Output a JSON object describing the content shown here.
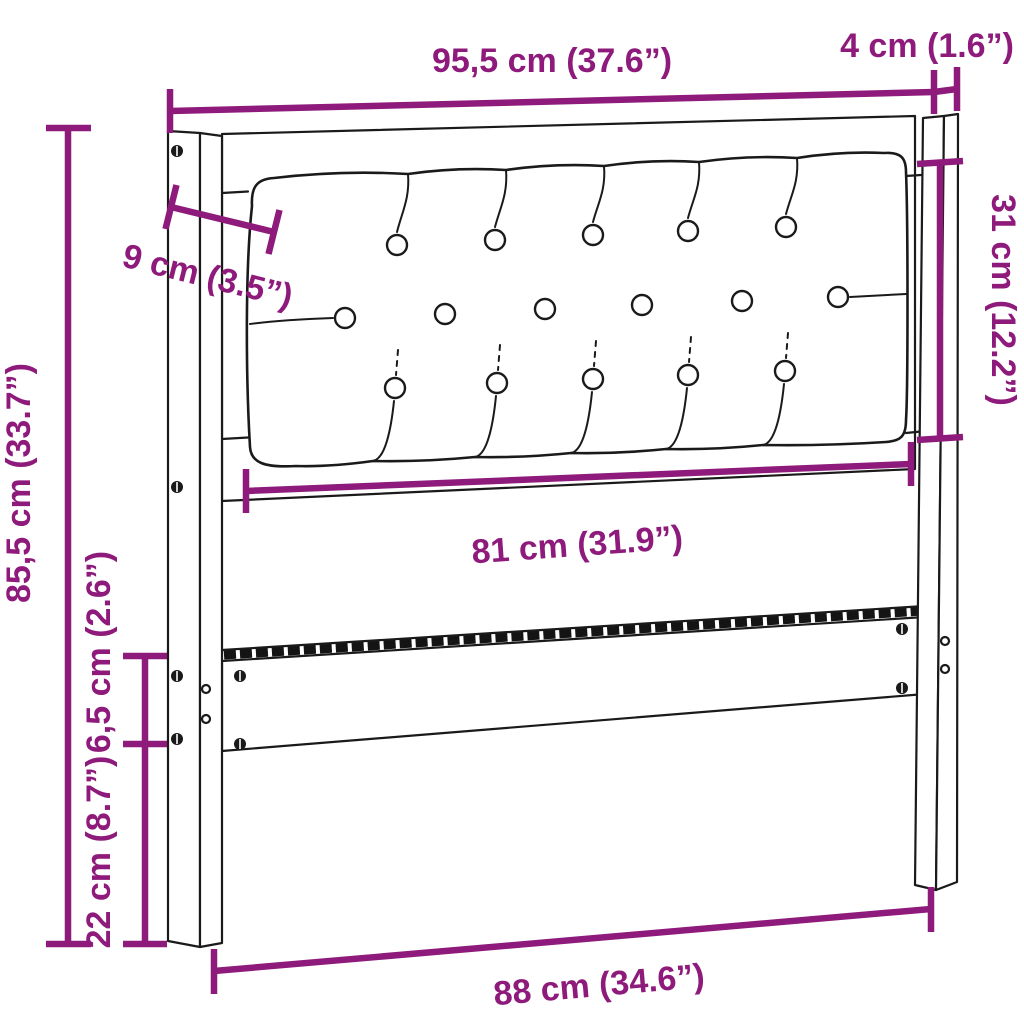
{
  "figure": {
    "type": "furniture-dimension-diagram",
    "subject": "upholstered tufted headboard with two posts and lower rail",
    "background_color": "#ffffff",
    "line_color": "#1a1a1a",
    "dimension_color": "#8e1b7b"
  },
  "tufting": {
    "button_rows": [
      5,
      6,
      5
    ]
  },
  "dimensions": {
    "top_width": {
      "label": "95,5 cm (37.6”)"
    },
    "post_depth": {
      "label": "4 cm (1.6”)"
    },
    "cushion_height": {
      "label": "31 cm (12.2”)"
    },
    "side_inset": {
      "label": "9 cm (3.5”)"
    },
    "total_height": {
      "label": "85,5 cm (33.7”)"
    },
    "cushion_width": {
      "label": "81 cm (31.9”)"
    },
    "rail_offset": {
      "label": "6,5 cm (2.6”)"
    },
    "leg_height": {
      "label": "22 cm (8.7”)"
    },
    "bottom_width": {
      "label": "88 cm (34.6”)"
    }
  }
}
